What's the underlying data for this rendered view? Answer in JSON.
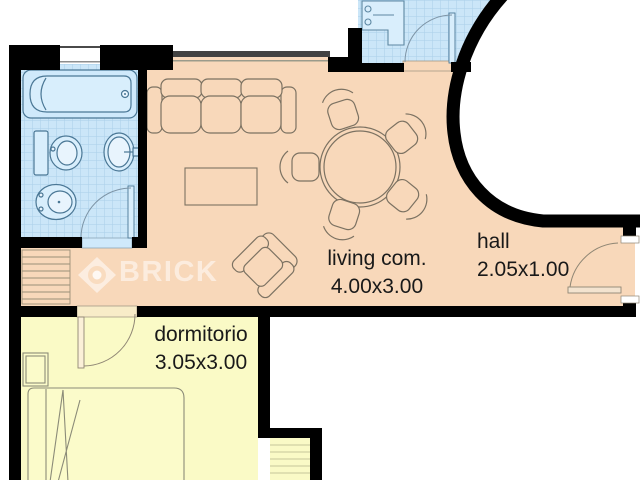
{
  "page": {
    "type": "apartment-floor-plan"
  },
  "rooms": [
    {
      "id": "living",
      "label": "living com.",
      "dims": "4.00x3.00"
    },
    {
      "id": "hall",
      "label": "hall",
      "dims": "2.05x1.00"
    },
    {
      "id": "dormitorio",
      "label": "dormitorio",
      "dims": "3.05x3.00"
    }
  ],
  "watermark": {
    "brand": "BRICK"
  },
  "colors": {
    "wall": "#000000",
    "floor_living": "#f8d8ba",
    "floor_bedroom": "#fafac6",
    "floor_tiled": "#cbe6f8",
    "tile_grid": "#a9cfe9",
    "fixture_stroke": "#4a7795",
    "furniture_stroke": "#7c7262",
    "bed_stroke": "#8b8b78",
    "text": "#191919"
  }
}
